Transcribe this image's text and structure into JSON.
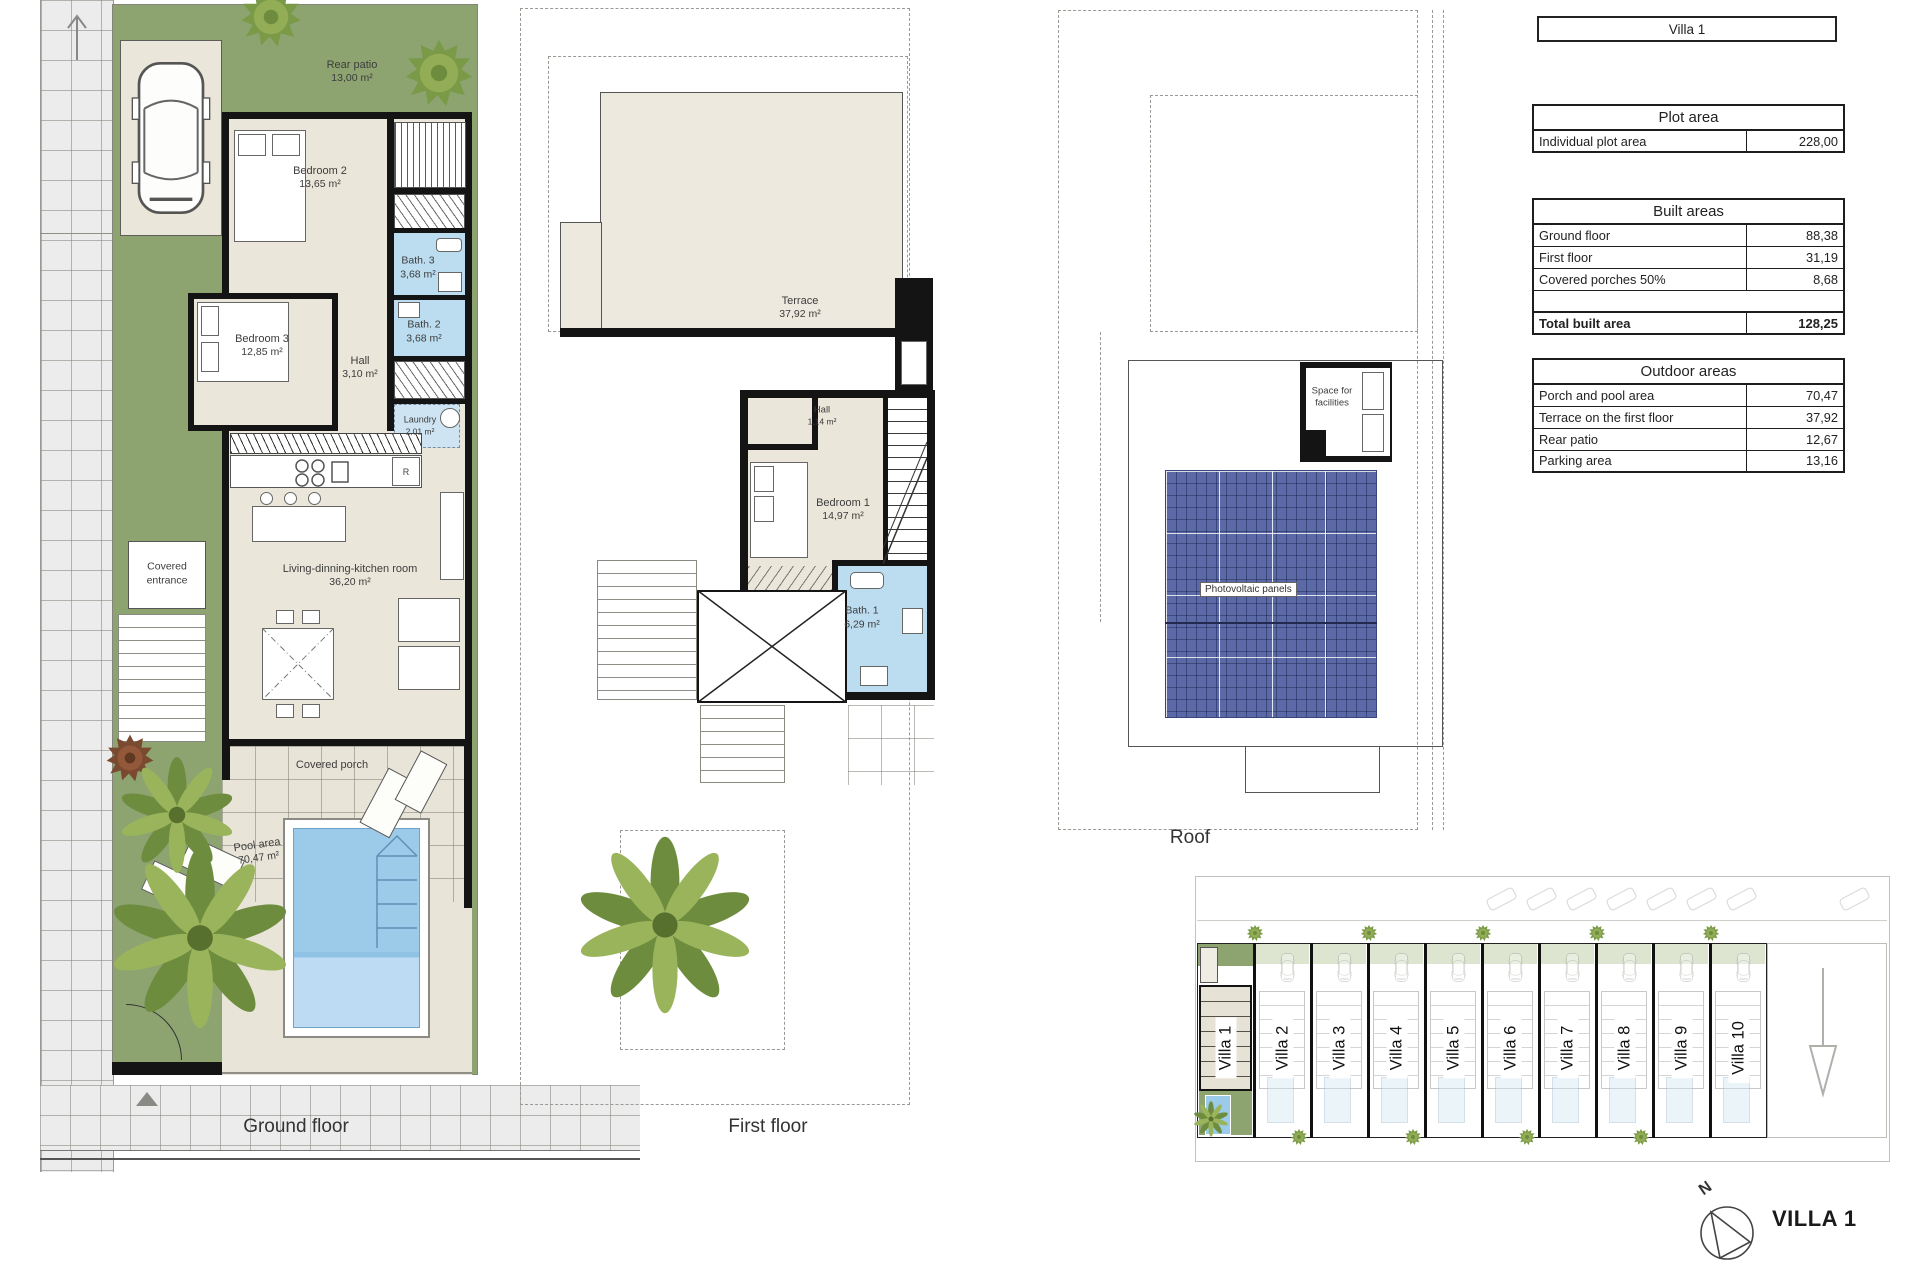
{
  "title_box": {
    "label": "Villa 1"
  },
  "tables": {
    "plot_area": {
      "title": "Plot area",
      "rows": [
        {
          "label": "Individual plot area",
          "value": "228,00"
        }
      ]
    },
    "built_areas": {
      "title": "Built areas",
      "rows": [
        {
          "label": "Ground floor",
          "value": "88,38"
        },
        {
          "label": "First floor",
          "value": "31,19"
        },
        {
          "label": "Covered porches 50%",
          "value": "8,68"
        },
        {
          "label": "",
          "value": ""
        }
      ],
      "total_row": {
        "label": "Total built area",
        "value": "128,25"
      }
    },
    "outdoor_areas": {
      "title": "Outdoor areas",
      "rows": [
        {
          "label": "Porch and pool area",
          "value": "70,47"
        },
        {
          "label": "Terrace on the first floor",
          "value": "37,92"
        },
        {
          "label": "Rear patio",
          "value": "12,67"
        },
        {
          "label": "Parking area",
          "value": "13,16"
        }
      ]
    }
  },
  "ground_floor": {
    "caption": "Ground floor",
    "labels": {
      "rear_patio": {
        "name": "Rear patio",
        "area": "13,00 m²"
      },
      "bedroom2": {
        "name": "Bedroom 2",
        "area": "13,65 m²"
      },
      "bath3": {
        "name": "Bath. 3",
        "area": "3,68 m²"
      },
      "bath2": {
        "name": "Bath. 2",
        "area": "3,68 m²"
      },
      "bedroom3": {
        "name": "Bedroom 3",
        "area": "12,85 m²"
      },
      "hall": {
        "name": "Hall",
        "area": "3,10 m²"
      },
      "laundry": {
        "name": "Laundry",
        "area": "2,01 m²"
      },
      "covered_entrance": {
        "line1": "Covered",
        "line2": "entrance"
      },
      "living": {
        "name": "Living-dinning-kitchen room",
        "area": "36,20 m²"
      },
      "covered_porch": {
        "name": "Covered porch"
      },
      "pool": {
        "name": "Pool area",
        "area": "70,47 m²"
      },
      "appliance_r": "R"
    }
  },
  "first_floor": {
    "caption": "First floor",
    "labels": {
      "terrace": {
        "name": "Terrace",
        "area": "37,92 m²"
      },
      "hall": {
        "name": "Hall",
        "area": "1,14 m²"
      },
      "bedroom1": {
        "name": "Bedroom 1",
        "area": "14,97 m²"
      },
      "bath1": {
        "name": "Bath. 1",
        "area": "6,29 m²"
      }
    }
  },
  "roof": {
    "caption": "Roof",
    "labels": {
      "space_for_facilities": {
        "line1": "Space for",
        "line2": "facilities"
      },
      "photovoltaic": "Photovoltaic panels"
    }
  },
  "site_plan": {
    "villas": [
      {
        "label": "Villa 1"
      },
      {
        "label": "Villa 2"
      },
      {
        "label": "Villa 3"
      },
      {
        "label": "Villa 4"
      },
      {
        "label": "Villa 5"
      },
      {
        "label": "Villa 6"
      },
      {
        "label": "Villa 7"
      },
      {
        "label": "Villa 8"
      },
      {
        "label": "Villa 9"
      },
      {
        "label": "Villa 10"
      }
    ]
  },
  "footer": {
    "north_letter": "N",
    "villa_title": "VILLA 1"
  },
  "colors": {
    "garden_green": "#8da471",
    "floor_cream": "#ebe6da",
    "bath_blue": "#bcdcf0",
    "pool_blue": "#9ccbe9",
    "pv_blue": "#5b69a6",
    "wall_black": "#141414"
  }
}
